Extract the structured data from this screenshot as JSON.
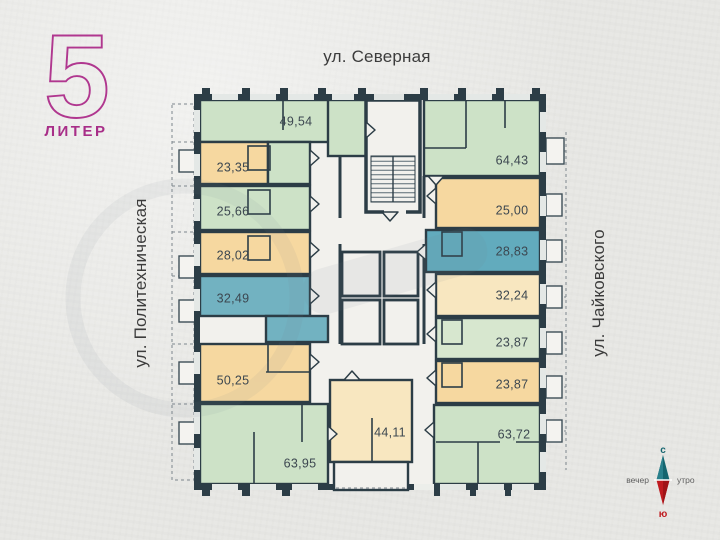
{
  "plan": {
    "liter": {
      "number": "5",
      "label": "ЛИТЕР"
    },
    "streets": {
      "top": "ул. Северная",
      "left": "ул. Политехническая",
      "right": "ул. Чайковского"
    },
    "compass": {
      "north": "с",
      "south": "ю",
      "west": "вечер",
      "east": "утро"
    },
    "colors": {
      "accent_magenta": "#b0378f",
      "wall": "#2c3d46",
      "green": "#cde2c7",
      "green_light": "#d7e7cf",
      "orange": "#f6d8a0",
      "cream": "#f8e7c0",
      "blue": "#72b2c1",
      "blue_deep": "#62abbd",
      "corridor": "#f2f1ed",
      "label_text": "#3c4750",
      "compass_north": "#15656f",
      "compass_south": "#bf1a1f"
    },
    "apartments": [
      {
        "area": "49,54",
        "label": [
          296,
          121
        ],
        "rects": [
          {
            "xywh": [
              200,
              100,
              162,
              42
            ],
            "c": "green"
          },
          {
            "xywh": [
              328,
              100,
              38,
              56
            ],
            "c": "green"
          }
        ]
      },
      {
        "area": "23,35",
        "label": [
          233,
          167
        ],
        "rects": [
          {
            "xywh": [
              200,
              142,
              68,
              42
            ],
            "c": "orange"
          },
          {
            "xywh": [
              268,
              142,
              42,
              42
            ],
            "c": "green"
          }
        ]
      },
      {
        "area": "25,66",
        "label": [
          233,
          211
        ],
        "rects": [
          {
            "xywh": [
              200,
              186,
              110,
              44
            ],
            "c": "green"
          }
        ]
      },
      {
        "area": "28,02",
        "label": [
          233,
          255
        ],
        "rects": [
          {
            "xywh": [
              200,
              232,
              110,
              42
            ],
            "c": "orange"
          }
        ]
      },
      {
        "area": "32,49",
        "label": [
          233,
          298
        ],
        "rects": [
          {
            "xywh": [
              200,
              276,
              110,
              40
            ],
            "c": "blue"
          },
          {
            "xywh": [
              266,
              316,
              62,
              26
            ],
            "c": "blue"
          }
        ]
      },
      {
        "area": "50,25",
        "label": [
          233,
          380
        ],
        "rects": [
          {
            "xywh": [
              200,
              344,
              110,
              58
            ],
            "c": "orange"
          }
        ]
      },
      {
        "area": "63,95",
        "label": [
          300,
          463
        ],
        "rects": [
          {
            "xywh": [
              200,
              404,
              128,
              80
            ],
            "c": "green"
          }
        ]
      },
      {
        "area": "44,11",
        "label": [
          390,
          432
        ],
        "rects": [
          {
            "xywh": [
              330,
              380,
              82,
              82
            ],
            "c": "cream"
          }
        ]
      },
      {
        "area": "64,43",
        "label": [
          512,
          160
        ],
        "rects": [
          {
            "xywh": [
              424,
              100,
              116,
              76
            ],
            "c": "green"
          }
        ]
      },
      {
        "area": "25,00",
        "label": [
          512,
          210
        ],
        "rects": [
          {
            "xywh": [
              436,
              178,
              104,
              50
            ],
            "c": "orange"
          }
        ]
      },
      {
        "area": "28,83",
        "label": [
          512,
          251
        ],
        "rects": [
          {
            "xywh": [
              426,
              230,
              114,
              42
            ],
            "c": "blue_deep"
          }
        ]
      },
      {
        "area": "32,24",
        "label": [
          512,
          295
        ],
        "rects": [
          {
            "xywh": [
              436,
              274,
              104,
              42
            ],
            "c": "cream"
          }
        ]
      },
      {
        "area": "23,87",
        "label": [
          512,
          342
        ],
        "rects": [
          {
            "xywh": [
              436,
              318,
              104,
              41
            ],
            "c": "green_light"
          }
        ]
      },
      {
        "area": "23,87",
        "label": [
          512,
          384
        ],
        "rects": [
          {
            "xywh": [
              436,
              361,
              104,
              42
            ],
            "c": "orange"
          }
        ]
      },
      {
        "area": "63,72",
        "label": [
          514,
          434
        ],
        "rects": [
          {
            "xywh": [
              434,
              405,
              106,
              79
            ],
            "c": "green"
          }
        ]
      }
    ]
  }
}
